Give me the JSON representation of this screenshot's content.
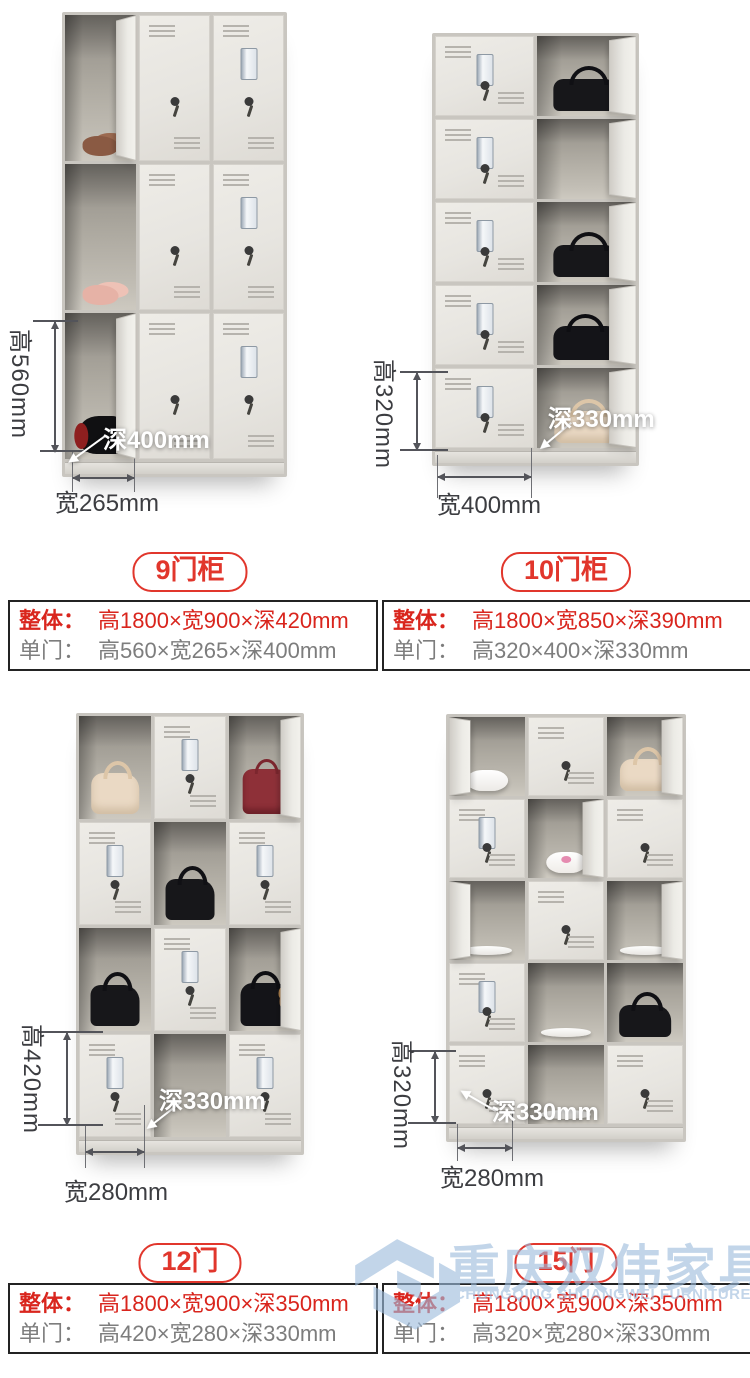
{
  "colors": {
    "accent_red": "#e1362c",
    "spec_red": "#d9251d",
    "spec_gray": "#7d7d7d",
    "dimension_text": "#3c3d41",
    "watermark_blue": "#9dbcdd",
    "table_border": "#232323"
  },
  "products": [
    {
      "badge": "9门柜",
      "spec": {
        "overall_label": "整体：",
        "overall_value": "高1800×宽900×深420mm",
        "door_label": "单门：",
        "door_value": "高560×宽265×深400mm"
      },
      "annotations": {
        "height": "高560mm",
        "width": "宽265mm",
        "depth": "深400mm"
      },
      "photo": {
        "cols": 3,
        "rows": 3,
        "cw": 71,
        "rh": 146,
        "cells": [
          {
            "o": 1,
            "it": "shoes-brown",
            "sw": "R"
          },
          {
            "c": 1
          },
          {
            "c": 1,
            "t": 1
          },
          {
            "o": 1,
            "it": "shoes-pink"
          },
          {
            "c": 1
          },
          {
            "c": 1,
            "t": 1
          },
          {
            "o": 1,
            "it": "boot",
            "sw": "R"
          },
          {
            "c": 1
          },
          {
            "c": 1,
            "t": 1
          }
        ]
      }
    },
    {
      "badge": "10门柜",
      "spec": {
        "overall_label": "整体：",
        "overall_value": "高1800×宽850×深390mm",
        "door_label": "单门：",
        "door_value": "高320×400×深330mm"
      },
      "annotations": {
        "height": "高320mm",
        "width": "宽400mm",
        "depth": "深330mm"
      },
      "photo": {
        "cols": 2,
        "rows": 5,
        "cw": 99,
        "rh": 80,
        "cells": [
          {
            "c": 1,
            "t": 1
          },
          {
            "o": 1,
            "it": "bag-black",
            "sw": "R"
          },
          {
            "c": 1,
            "t": 1
          },
          {
            "o": 1,
            "sw": "R"
          },
          {
            "c": 1,
            "t": 1
          },
          {
            "o": 1,
            "it": "bag-black",
            "sw": "R"
          },
          {
            "c": 1,
            "t": 1
          },
          {
            "o": 1,
            "it": "bag-black-teddy",
            "sw": "R"
          },
          {
            "c": 1,
            "t": 1
          },
          {
            "o": 1,
            "it": "bag-cream",
            "sw": "R"
          }
        ]
      }
    },
    {
      "badge": "12门",
      "spec": {
        "overall_label": "整体：",
        "overall_value": "高1800×宽900×深350mm",
        "door_label": "单门：",
        "door_value": "高420×宽280×深330mm"
      },
      "annotations": {
        "height": "高420mm",
        "width": "宽280mm",
        "depth": "深330mm"
      },
      "photo": {
        "cols": 3,
        "rows": 4,
        "cw": 72,
        "rh": 103,
        "cells": [
          {
            "o": 1,
            "it": "bag-cream"
          },
          {
            "c": 1,
            "t": 1
          },
          {
            "o": 1,
            "it": "bag-red",
            "sw": "R"
          },
          {
            "c": 1,
            "t": 1
          },
          {
            "o": 1,
            "it": "bag-black"
          },
          {
            "c": 1,
            "t": 1
          },
          {
            "o": 1,
            "it": "bag-black"
          },
          {
            "c": 1,
            "t": 1
          },
          {
            "o": 1,
            "it": "bag-black-teddy",
            "sw": "R"
          },
          {
            "c": 1,
            "t": 1
          },
          {
            "o": 1
          },
          {
            "c": 1,
            "t": 1
          }
        ]
      }
    },
    {
      "badge": "15门",
      "spec": {
        "overall_label": "整体：",
        "overall_value": "高1800×宽900×深350mm",
        "door_label": "单门：",
        "door_value": "高320×宽280×深330mm"
      },
      "annotations": {
        "height": "高320mm",
        "width": "宽280mm",
        "depth": "深330mm"
      },
      "photo": {
        "cols": 3,
        "rows": 5,
        "cw": 76,
        "rh": 79,
        "cells": [
          {
            "o": 1,
            "it": "bowl",
            "sw": "L"
          },
          {
            "c": 1
          },
          {
            "o": 1,
            "it": "bag-cream",
            "sw": "R"
          },
          {
            "c": 1,
            "t": 1
          },
          {
            "o": 1,
            "it": "bowl-pink",
            "sw": "R"
          },
          {
            "c": 1
          },
          {
            "o": 1,
            "it": "plate",
            "sw": "L"
          },
          {
            "c": 1
          },
          {
            "o": 1,
            "it": "plate",
            "sw": "R"
          },
          {
            "c": 1,
            "t": 1
          },
          {
            "o": 1,
            "it": "plate"
          },
          {
            "o": 1,
            "it": "bag-black"
          },
          {
            "c": 1
          },
          {
            "o": 1,
            "it": "plate"
          },
          {
            "c": 1
          }
        ]
      }
    }
  ],
  "watermark": {
    "cn": "重庆双伟家具",
    "en": "CHONGQING SHUANGWEI FURNITURE"
  }
}
